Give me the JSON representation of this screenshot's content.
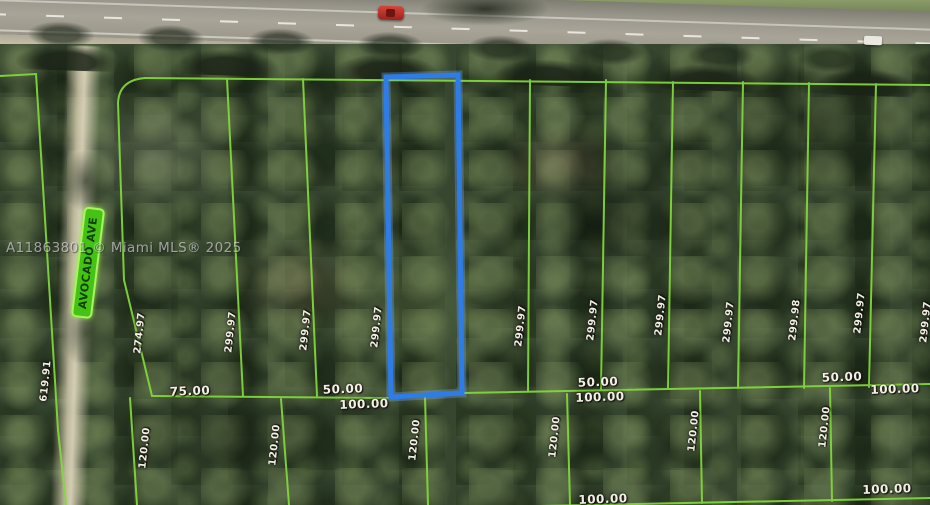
{
  "watermark": "A11863801 © Miami MLS® 2025",
  "street_label": "AVOCADO AVE",
  "dimension_labels": [
    {
      "text": "619.91",
      "orientation": "vertical"
    },
    {
      "text": "274.97",
      "orientation": "vertical"
    },
    {
      "text": "299.97",
      "orientation": "vertical"
    },
    {
      "text": "299.97",
      "orientation": "vertical"
    },
    {
      "text": "299.97",
      "orientation": "vertical"
    },
    {
      "text": "299.97",
      "orientation": "vertical"
    },
    {
      "text": "299.97",
      "orientation": "vertical"
    },
    {
      "text": "299.97",
      "orientation": "vertical"
    },
    {
      "text": "299.97",
      "orientation": "vertical"
    },
    {
      "text": "299.98",
      "orientation": "vertical"
    },
    {
      "text": "299.97",
      "orientation": "vertical"
    },
    {
      "text": "299.97",
      "orientation": "vertical"
    },
    {
      "text": "75.00",
      "orientation": "horizontal"
    },
    {
      "text": "50.00",
      "orientation": "horizontal"
    },
    {
      "text": "100.00",
      "orientation": "horizontal"
    },
    {
      "text": "50.00",
      "orientation": "horizontal"
    },
    {
      "text": "100.00",
      "orientation": "horizontal"
    },
    {
      "text": "50.00",
      "orientation": "horizontal"
    },
    {
      "text": "100.00",
      "orientation": "horizontal"
    },
    {
      "text": "120.00",
      "orientation": "vertical"
    },
    {
      "text": "120.00",
      "orientation": "vertical"
    },
    {
      "text": "120.00",
      "orientation": "vertical"
    },
    {
      "text": "120.00",
      "orientation": "vertical"
    },
    {
      "text": "120.00",
      "orientation": "vertical"
    },
    {
      "text": "120.00",
      "orientation": "vertical"
    },
    {
      "text": "100.00",
      "orientation": "horizontal"
    },
    {
      "text": "100.00",
      "orientation": "horizontal"
    }
  ],
  "colors": {
    "parcel_line": "#84d93c",
    "highlighted_parcel_outline": "#2e7ce8",
    "street_badge_bg": "#44c215",
    "street_badge_border": "#a9f35c",
    "street_badge_text": "#123f05",
    "highway": "#a8a498",
    "dirt_road": "#d9d1ba",
    "forest": "#36462f",
    "label_text": "#f4efe2"
  }
}
